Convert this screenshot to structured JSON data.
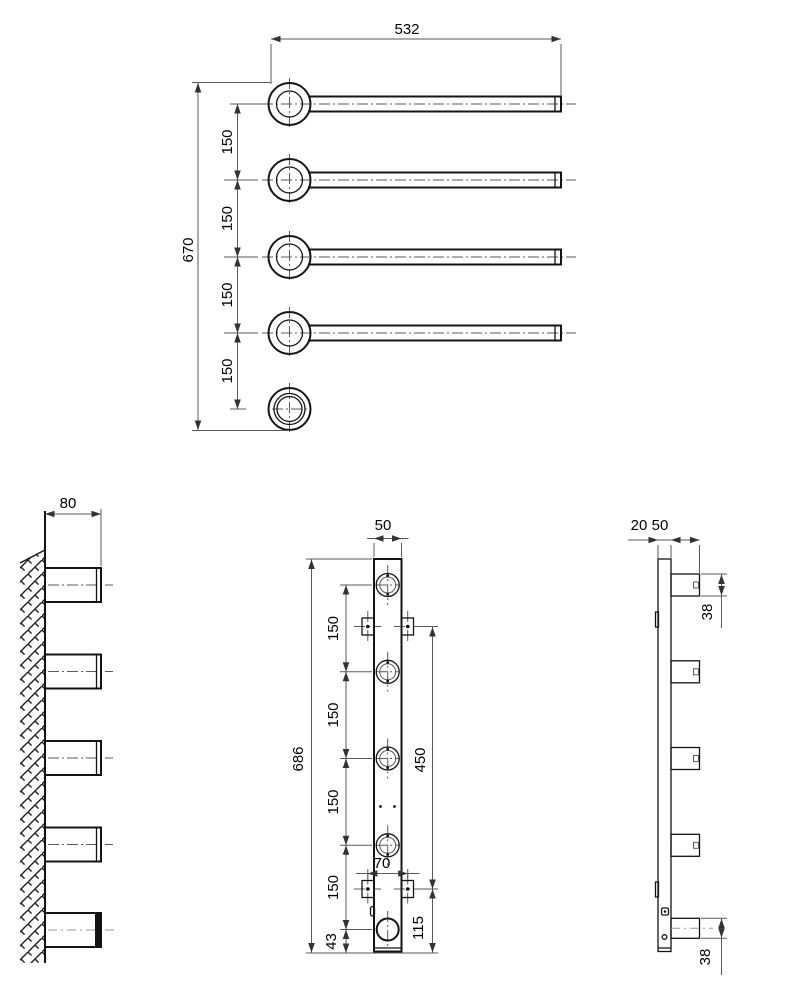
{
  "plan": {
    "width": "532",
    "height": "670",
    "spacings": [
      "150",
      "150",
      "150",
      "150"
    ]
  },
  "wall": {
    "arm_length": "80"
  },
  "front": {
    "bar_width": "50",
    "bar_height": "686",
    "spacings": [
      "150",
      "150",
      "150",
      "150"
    ],
    "bottom_offset": "43",
    "screw_span": "70",
    "bracket_span": "450",
    "bottom_span": "115"
  },
  "profile": {
    "plate_depth": "20",
    "stub_length": "50",
    "stub_top": "38",
    "stub_bottom": "38"
  },
  "colors": {
    "line": "#141414",
    "dim_line": "#5a5a5a",
    "background": "#ffffff"
  }
}
